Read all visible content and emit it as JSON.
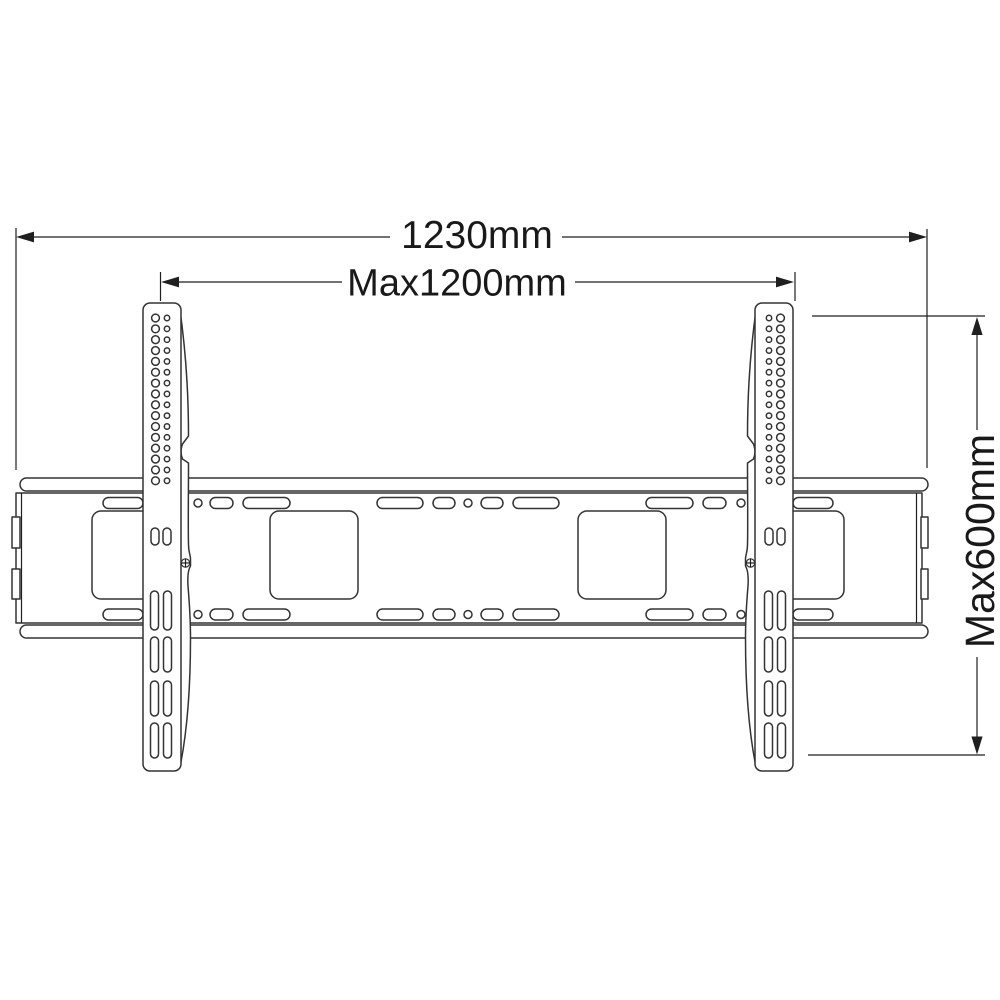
{
  "canvas": {
    "background": "#ffffff",
    "drawing_line_color": "#333333",
    "dimension_line_color": "#1f1f1f",
    "text_color": "#191919"
  },
  "drawing": {
    "kind": "technical-line-drawing",
    "subject": "flat TV wall mount bracket, front view",
    "labels": {
      "overall_width": "1230mm",
      "max_mount_width": "Max1200mm",
      "max_mount_height": "Max600mm"
    }
  }
}
